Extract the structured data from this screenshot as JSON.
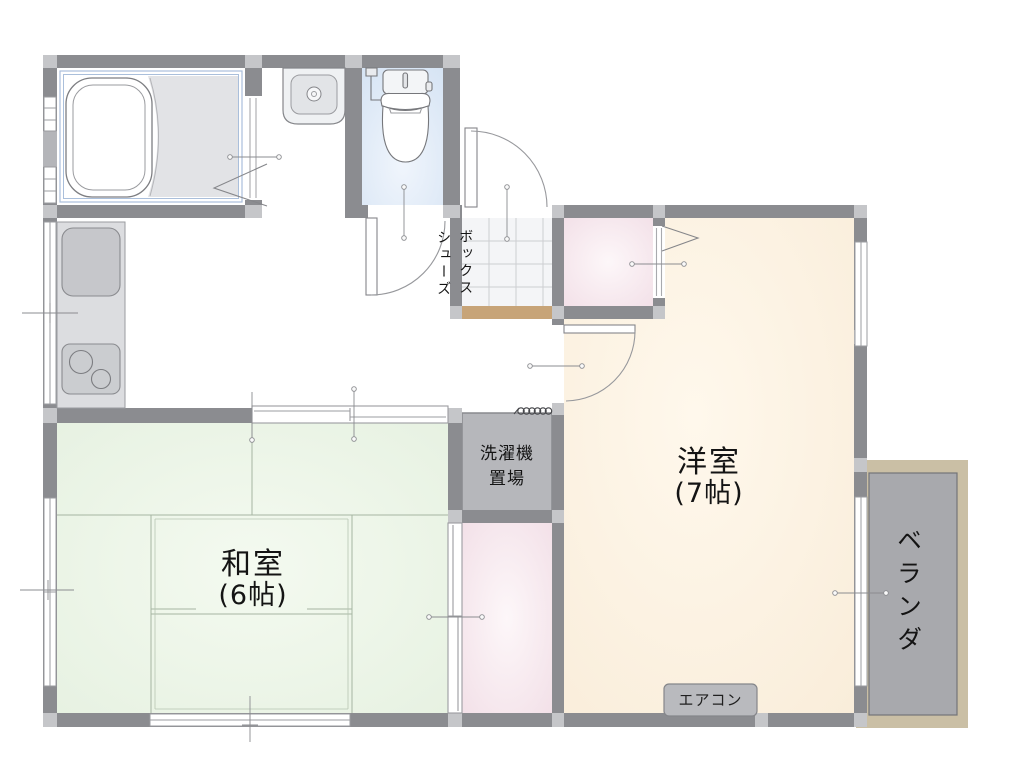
{
  "page": {
    "background": "#ffffff",
    "type": "apartment-floor-plan"
  },
  "labels": {
    "washitsu_name": "和室",
    "washitsu_size": "(6帖)",
    "youshitsu_name": "洋室",
    "youshitsu_size": "(7帖)",
    "veranda": "ベランダ",
    "laundry_line1": "洗濯機",
    "laundry_line2": "置場",
    "aircon": "エアコン",
    "shoebox_left_column": "シューズ",
    "shoebox_right_column": "ボックス"
  },
  "colors": {
    "wall": "#8b8c90",
    "pillar": "#c5c6c9",
    "tatami_green": "#eaf3e6",
    "wood_floor_cream": "#faf0de",
    "closet_pink": "#f4e3ea",
    "toilet_blue": "#dde9f6",
    "laundry_gray": "#b6b7bb",
    "veranda_floor": "#a8a9ad",
    "veranda_frame": "#cabfa5",
    "genkan_step_tan": "#c7a478",
    "bath_border_blue": "#aabfdb",
    "outline_gray": "#85868a",
    "text": "#141414"
  }
}
